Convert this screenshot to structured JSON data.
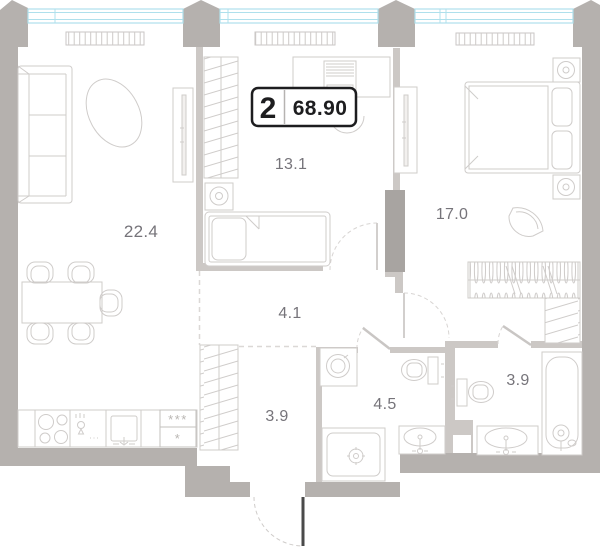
{
  "plan_title": "2-room apartment floor plan",
  "badge": {
    "rooms_count": "2",
    "total_area": "68.90"
  },
  "rooms": {
    "living": {
      "label": "living-kitchen",
      "area": "22.4"
    },
    "bedroom_small": {
      "label": "bedroom-small",
      "area": "13.1"
    },
    "bedroom_master": {
      "label": "bedroom-master",
      "area": "17.0"
    },
    "hallway": {
      "label": "hallway",
      "area": "4.1"
    },
    "corridor": {
      "label": "corridor",
      "area": "3.9"
    },
    "bathroom_main": {
      "label": "bathroom-main",
      "area": "4.5"
    },
    "bathroom_second": {
      "label": "bathroom-second",
      "area": "3.9"
    }
  },
  "kitchen": {
    "freezer_marks_top": "***",
    "freezer_mark_bottom": "*"
  },
  "colors": {
    "wall_exterior": "#b5b1ae",
    "wall_interior": "#ccc8c5",
    "wall_dark": "#a8a4a1",
    "window": "#afe0ec",
    "furniture_line": "#cfccca",
    "label_text": "#76747a",
    "badge_ink": "#1d1d1f",
    "entrance_door": "#4a4a4a"
  }
}
